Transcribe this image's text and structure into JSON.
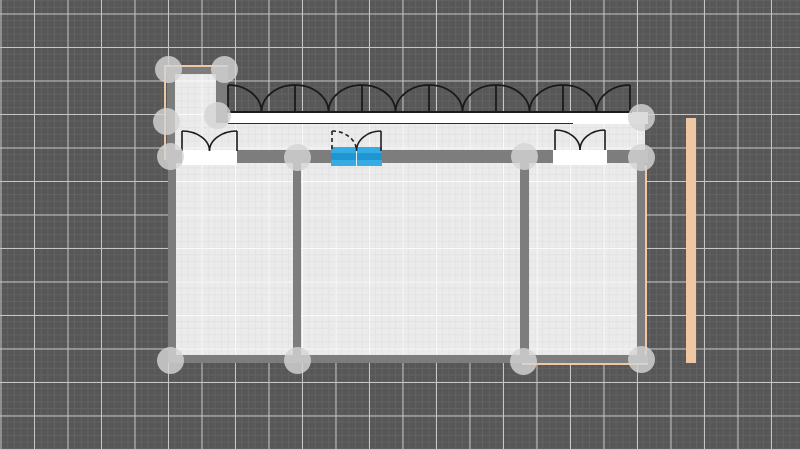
{
  "editor": {
    "type": "floor-plan-canvas",
    "selected_element": "double-door-center"
  },
  "canvas": {
    "width": 800,
    "height": 450,
    "background": "#575757",
    "grid": {
      "minor_color": "#626262",
      "major_color": "#c6c6c6",
      "minor_step": 6.7,
      "major_step": 33.5,
      "offset_x": 0.5,
      "offset_y": 13.5
    }
  },
  "colors": {
    "wall": "#7d7d7d",
    "floor": "#ebebeb",
    "floor_grid_minor": "#e3e3e3",
    "floor_grid_major": "#fafafa",
    "outline": "#1a1a1a",
    "white": "#ffffff",
    "selection_blue": "#35ace4",
    "selection_blue_band": "#1f96d2",
    "handle": "rgba(212,212,212,0.82)",
    "tan": "#efc8a3"
  },
  "floors": [
    {
      "name": "tower-room-floor",
      "x": 174,
      "y": 74,
      "w": 42,
      "h": 77
    },
    {
      "name": "tower-doorway-floor",
      "x": 216,
      "y": 121,
      "w": 12,
      "h": 30
    },
    {
      "name": "corridor-floor",
      "x": 216,
      "y": 123,
      "w": 429,
      "h": 28
    },
    {
      "name": "main-room-floor",
      "x": 176,
      "y": 163,
      "w": 461,
      "h": 192
    }
  ],
  "walls": [
    {
      "name": "tower-wall-top",
      "x": 166,
      "y": 67,
      "w": 62,
      "h": 7
    },
    {
      "name": "tower-wall-left",
      "x": 167,
      "y": 67,
      "w": 8,
      "h": 93
    },
    {
      "name": "tower-wall-right",
      "x": 216,
      "y": 67,
      "w": 12,
      "h": 56
    },
    {
      "name": "front-wall",
      "x": 166,
      "y": 150,
      "w": 482,
      "h": 13
    },
    {
      "name": "left-wall",
      "x": 168,
      "y": 151,
      "w": 8,
      "h": 212
    },
    {
      "name": "right-wall",
      "x": 637,
      "y": 155,
      "w": 8,
      "h": 208
    },
    {
      "name": "bottom-wall",
      "x": 168,
      "y": 355,
      "w": 480,
      "h": 8
    },
    {
      "name": "partition-wall-1",
      "x": 293,
      "y": 163,
      "w": 8,
      "h": 192
    },
    {
      "name": "partition-wall-2",
      "x": 520,
      "y": 163,
      "w": 9,
      "h": 192
    }
  ],
  "terrace": {
    "name": "terrace-deck",
    "x": 228,
    "y": 112,
    "w": 420,
    "h": 12,
    "top_edge": {
      "x1": 228,
      "x2": 632,
      "y": 112
    },
    "bottom_edge": {
      "x1": 228,
      "x2": 573,
      "y": 123.5
    }
  },
  "window_row": {
    "name": "french-window-row",
    "y_top": 85,
    "y_base": 112,
    "bays": [
      [
        228,
        295
      ],
      [
        295,
        362
      ],
      [
        362,
        429
      ],
      [
        429,
        496
      ],
      [
        496,
        563
      ],
      [
        563,
        630
      ]
    ]
  },
  "doors": [
    {
      "name": "double-door-left",
      "x1": 182,
      "x2": 237,
      "y_top": 131,
      "y_pivot": 151,
      "selected": false,
      "threshold": {
        "x": 182,
        "y": 150,
        "w": 55,
        "h": 15
      }
    },
    {
      "name": "double-door-center",
      "x1": 332,
      "x2": 381,
      "y_top": 131,
      "y_pivot": 151,
      "selected": true,
      "threshold": {
        "x": 331,
        "y": 147,
        "w": 51,
        "h": 19
      }
    },
    {
      "name": "double-door-right",
      "x1": 555,
      "x2": 605,
      "y_top": 130,
      "y_pivot": 150,
      "selected": false,
      "threshold": {
        "x": 553,
        "y": 150,
        "w": 54,
        "h": 15
      }
    }
  ],
  "tan_elements": [
    {
      "name": "side-wall-strip",
      "x": 686,
      "y": 118,
      "w": 10,
      "h": 245
    },
    {
      "name": "right-wall-outline",
      "x": 645,
      "y": 165,
      "w": 2,
      "h": 198
    },
    {
      "name": "bottom-wall-outline",
      "x": 522,
      "y": 363,
      "w": 126,
      "h": 2
    },
    {
      "name": "tower-left-outline",
      "x": 164,
      "y": 65,
      "w": 2,
      "h": 95
    },
    {
      "name": "tower-top-outline",
      "x": 164,
      "y": 65,
      "w": 64,
      "h": 2
    }
  ],
  "handles": [
    {
      "name": "handle-tower-top-left",
      "cx": 168,
      "cy": 69
    },
    {
      "name": "handle-tower-top-right",
      "cx": 224,
      "cy": 69
    },
    {
      "name": "handle-tower-left-mid",
      "cx": 166,
      "cy": 121
    },
    {
      "name": "handle-tower-right-mid",
      "cx": 217,
      "cy": 115
    },
    {
      "name": "handle-front-wall-left",
      "cx": 170,
      "cy": 156
    },
    {
      "name": "handle-partition-1-top",
      "cx": 297,
      "cy": 157
    },
    {
      "name": "handle-partition-2-top",
      "cx": 524,
      "cy": 156
    },
    {
      "name": "handle-terrace-right",
      "cx": 641,
      "cy": 117
    },
    {
      "name": "handle-front-wall-right",
      "cx": 641,
      "cy": 157
    },
    {
      "name": "handle-bottom-left",
      "cx": 170,
      "cy": 360
    },
    {
      "name": "handle-partition-1-bottom",
      "cx": 297,
      "cy": 360
    },
    {
      "name": "handle-partition-2-bottom",
      "cx": 523,
      "cy": 361
    },
    {
      "name": "handle-bottom-right",
      "cx": 641,
      "cy": 359
    }
  ]
}
